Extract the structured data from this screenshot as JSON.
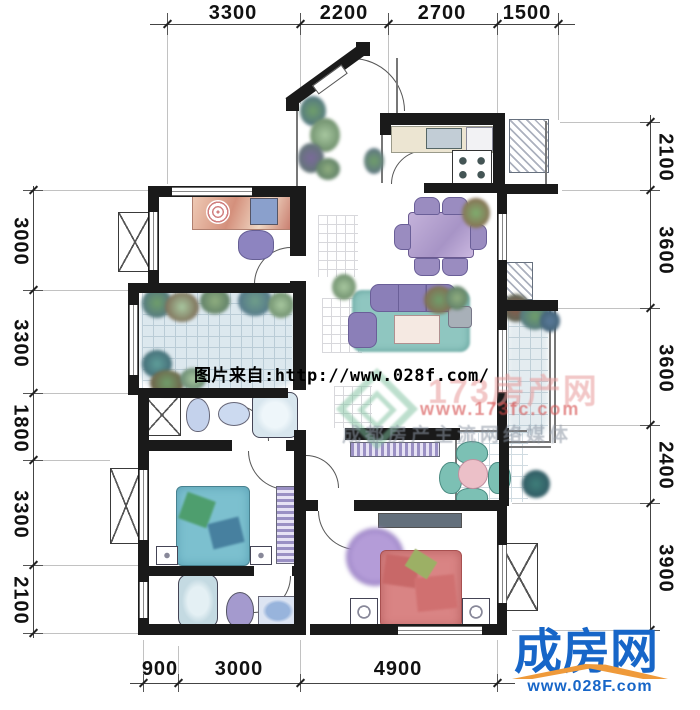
{
  "dimensions": {
    "top": [
      "3300",
      "2200",
      "2700",
      "1500"
    ],
    "left": [
      "3000",
      "3300",
      "1800",
      "3300",
      "2100"
    ],
    "right": [
      "2100",
      "3600",
      "3600",
      "2400",
      "3900"
    ],
    "bottom": [
      "900",
      "3000",
      "4900"
    ]
  },
  "watermark": {
    "caption": "图片来自:http://www.028f.com/",
    "site_name": "173房产网",
    "site_url": "www.173fc.com",
    "site_slogan": "成都房产主流网络媒体"
  },
  "brand": {
    "name": "成房网",
    "url": "www.028F.com"
  },
  "colors": {
    "wall": "#1a1a1a",
    "brand-blue": "#1766c8",
    "brand-orange": "#ef9a3a",
    "wm-pink": "#e89a9a",
    "wm-red": "#d44a4a",
    "wm-gray": "#8a94a2",
    "wm-green": "#7cbf9c"
  }
}
